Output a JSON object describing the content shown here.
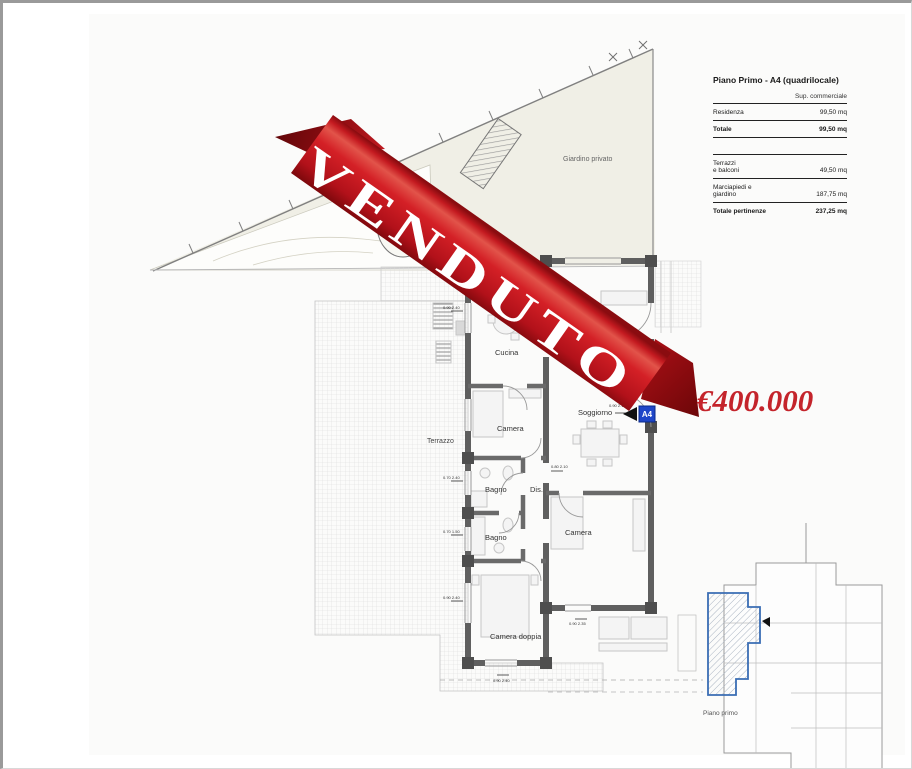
{
  "ribbon": {
    "label": "VENDUTO",
    "color": "#cf1b22"
  },
  "price": {
    "value": "€400.000",
    "color": "#c4242b"
  },
  "summary_table": {
    "title": "Piano Primo - A4 (quadrilocale)",
    "column_header": "Sup. commerciale",
    "rows": [
      {
        "label": "Residenza",
        "value": "99,50 mq"
      },
      {
        "label": "Totale",
        "value": "99,50 mq"
      },
      {
        "label": "Terrazzi\ne balconi",
        "value": "49,50 mq"
      },
      {
        "label": "Marciapiedi e\ngiardino",
        "value": "187,75 mq"
      },
      {
        "label": "Totale pertinenze",
        "value": "237,25 mq"
      }
    ]
  },
  "plan": {
    "garden_label": "Giardino privato",
    "terrace_label": "Terrazzo",
    "rooms": {
      "cucina": "Cucina",
      "soggiorno": "Soggiorno",
      "camera1": "Camera",
      "bagno1": "Bagno",
      "disimpegno": "Dis.",
      "bagno2": "Bagno",
      "camera2": "Camera",
      "camera_doppia": "Camera doppia"
    },
    "unit_badge": "A4",
    "dimensions": [
      {
        "text": "0.90 2.40"
      },
      {
        "text": "0.70 2.40"
      },
      {
        "text": "0.70 1.50"
      },
      {
        "text": "0.90 2.40"
      },
      {
        "text": "0.80 2.10"
      },
      {
        "text": "0.90 2.10"
      },
      {
        "text": "0.90 2.35"
      },
      {
        "text": "0.90 2.40"
      }
    ]
  },
  "keymap": {
    "label": "Piano primo"
  }
}
